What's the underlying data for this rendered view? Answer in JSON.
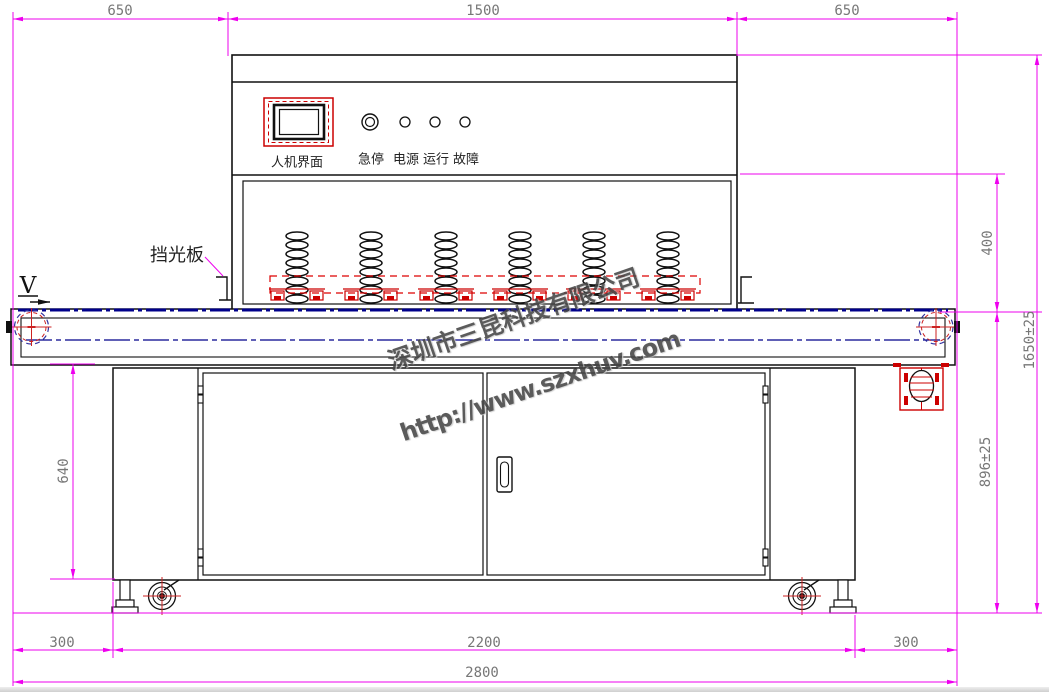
{
  "labels": {
    "light_shield": "挡光板",
    "direction": "V",
    "hmi_screen": "人机界面",
    "indicators": [
      "急停",
      "电源",
      "运行",
      "故障"
    ]
  },
  "dimensions": {
    "top": [
      "650",
      "1500",
      "650"
    ],
    "left_cabinet_height": "640",
    "right": {
      "chamber_to_belt": "400",
      "total_height": "1650±25",
      "belt_height": "896±25"
    },
    "bottom": [
      "300",
      "2200",
      "300",
      "2800"
    ]
  },
  "watermark": {
    "company": "深圳市三昆科技有限公司",
    "url": "http://www.szxhuv.com"
  },
  "colors": {
    "dimension_line": "#ee00ee",
    "dimension_text": "#777777",
    "line": "#111111",
    "red_accent": "#cc0000",
    "belt_blue": "#00008b"
  }
}
